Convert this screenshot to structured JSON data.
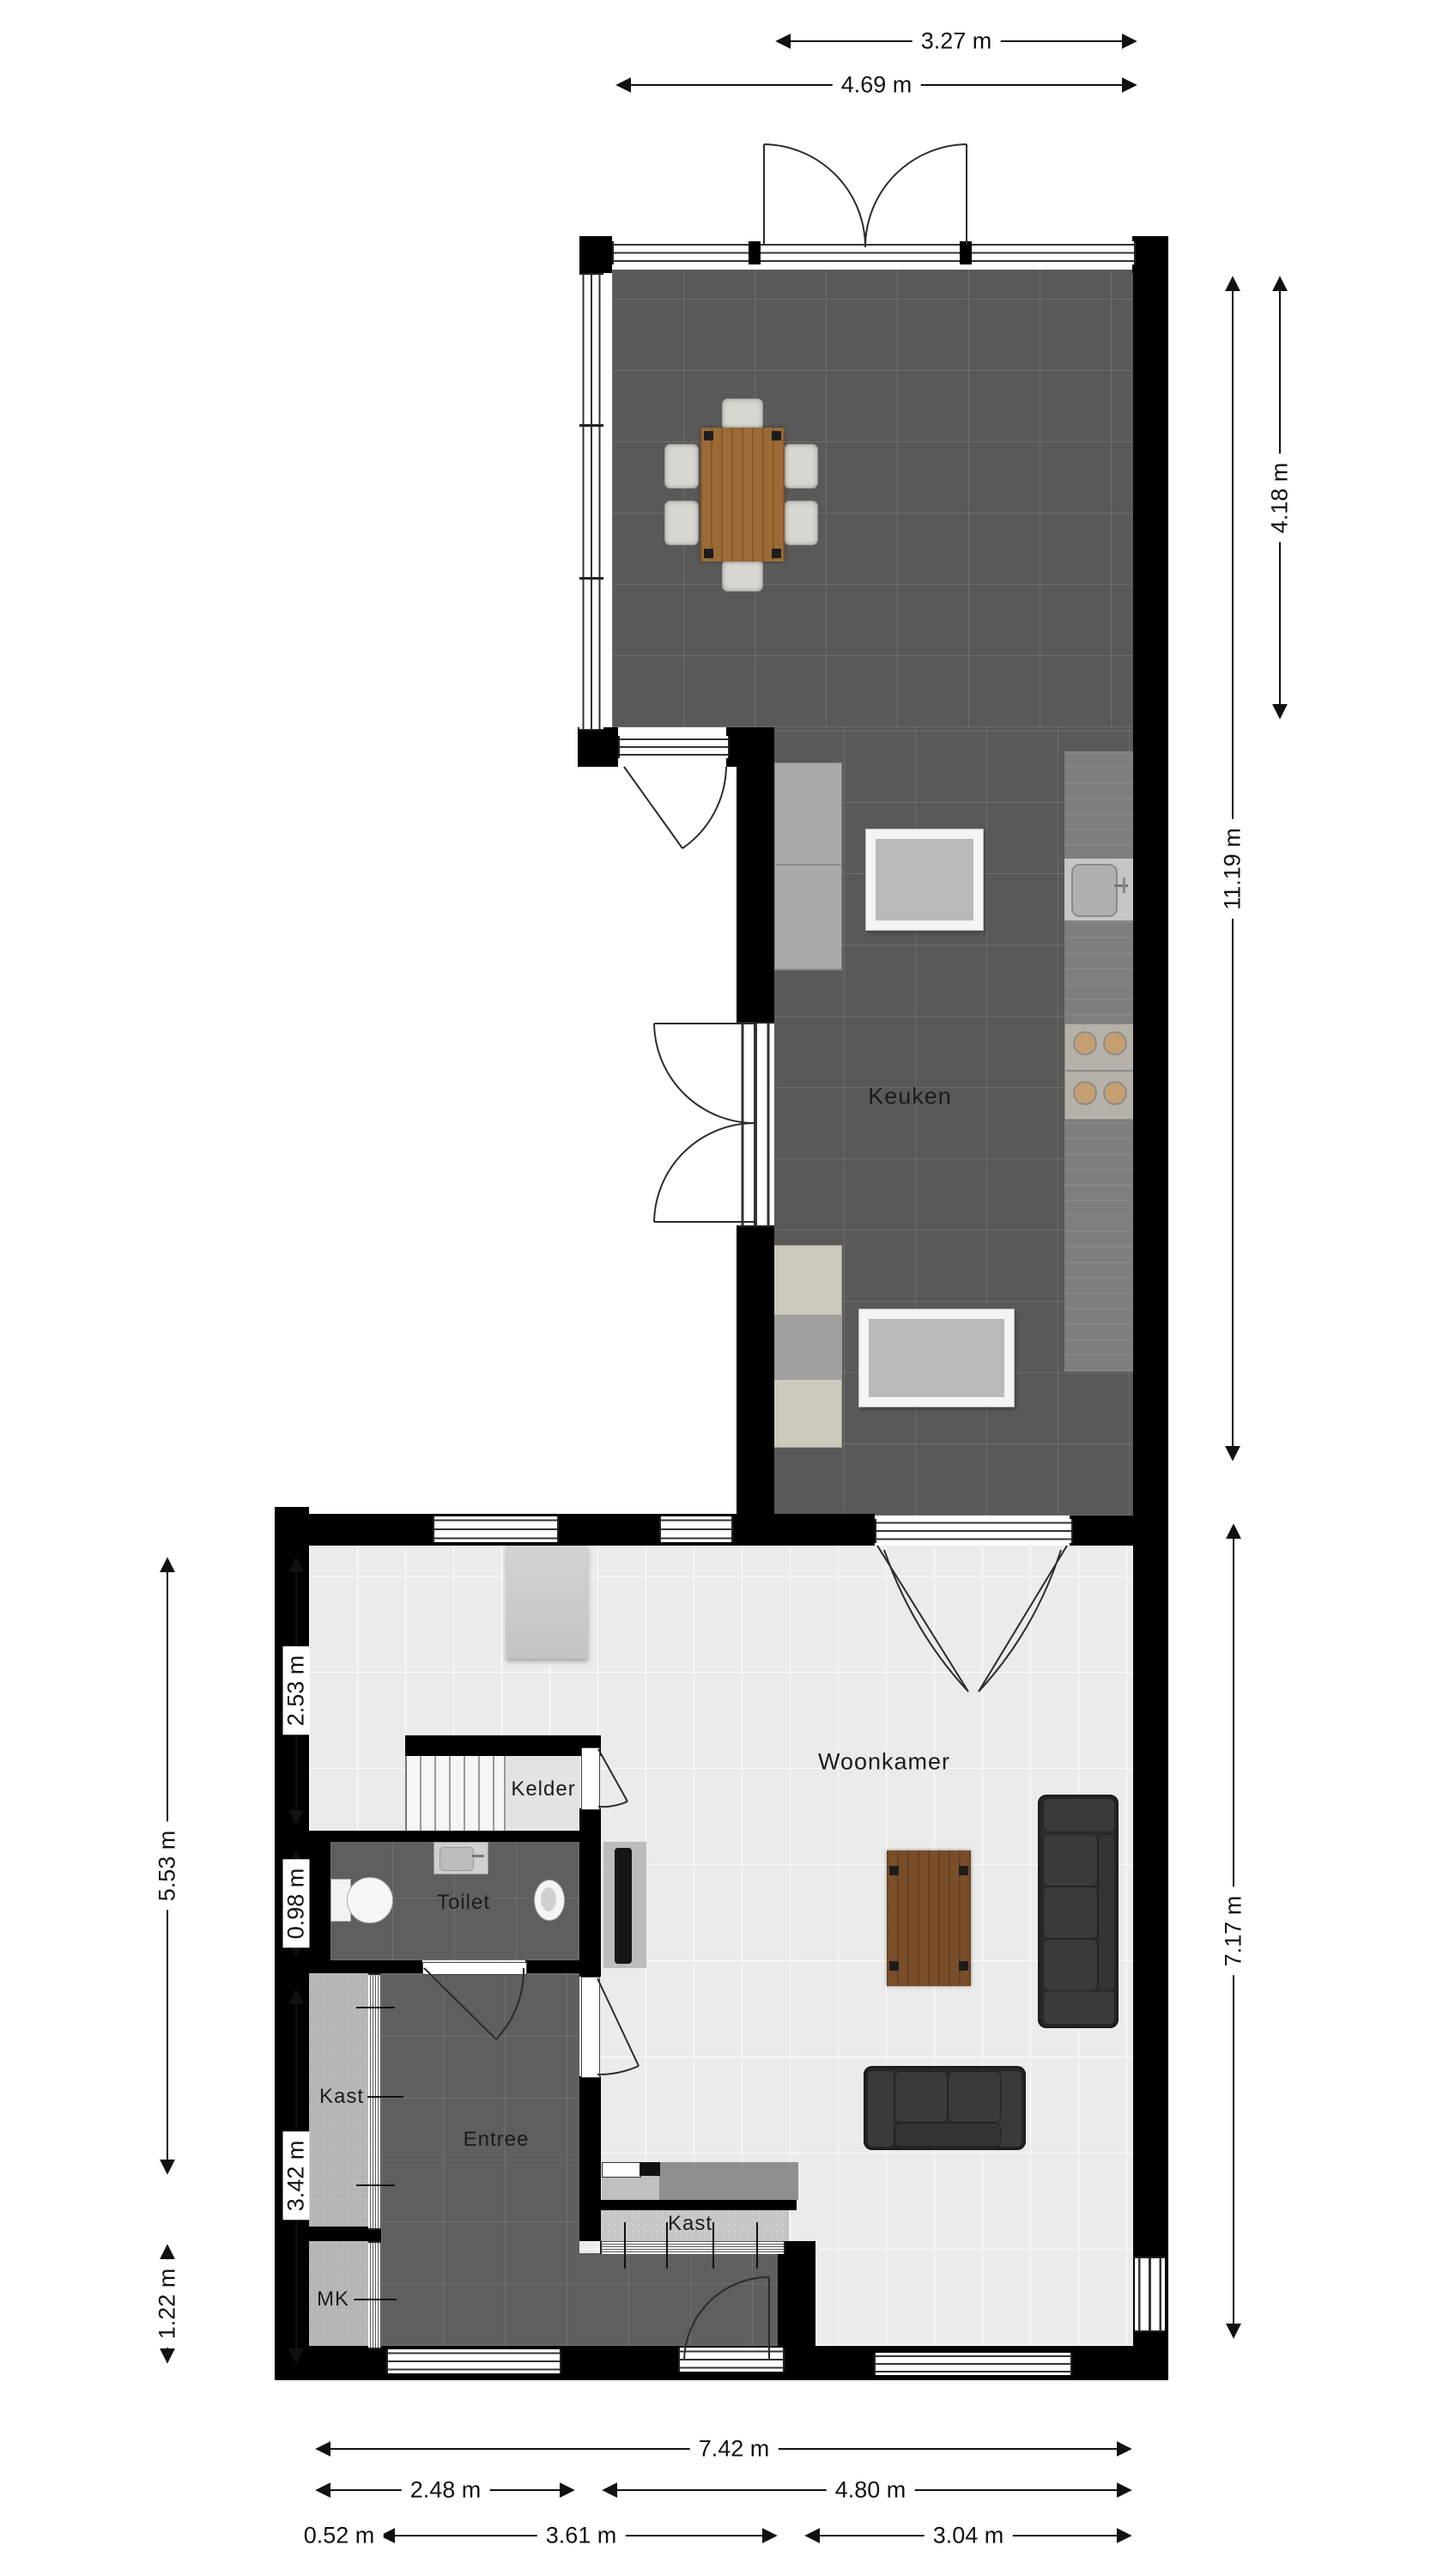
{
  "plan": {
    "rooms": {
      "keuken": "Keuken",
      "woonkamer": "Woonkamer",
      "kelder": "Kelder",
      "toilet": "Toilet",
      "kast_hal": "Kast",
      "entree": "Entree",
      "mk": "MK",
      "kast_woonkamer": "Kast"
    },
    "dimensions": {
      "top": [
        "3.27 m",
        "4.69 m"
      ],
      "right": [
        "4.18 m",
        "11.19 m",
        "7.17 m"
      ],
      "left": [
        "2.53 m",
        "0.98 m",
        "3.42 m",
        "5.53 m",
        "1.22 m"
      ],
      "bottom": [
        "7.42 m",
        "2.48 m",
        "4.80 m",
        "0.52 m",
        "3.61 m",
        "3.04 m"
      ]
    },
    "colors": {
      "wall": "#000000",
      "kitchen_floor": "#595959",
      "living_floor": "#ebebeb",
      "hall_floor": "#5f5f5f",
      "closet_floor": "#b5b5b5",
      "cellar_floor": "#e3e3e3",
      "counter_gray": "#a9a9a9",
      "counter_dark": "#7e7e7e",
      "counter_beige": "#ccc8bb",
      "wood_table": "#9c6b35",
      "sofa": "#2f2f31"
    }
  }
}
